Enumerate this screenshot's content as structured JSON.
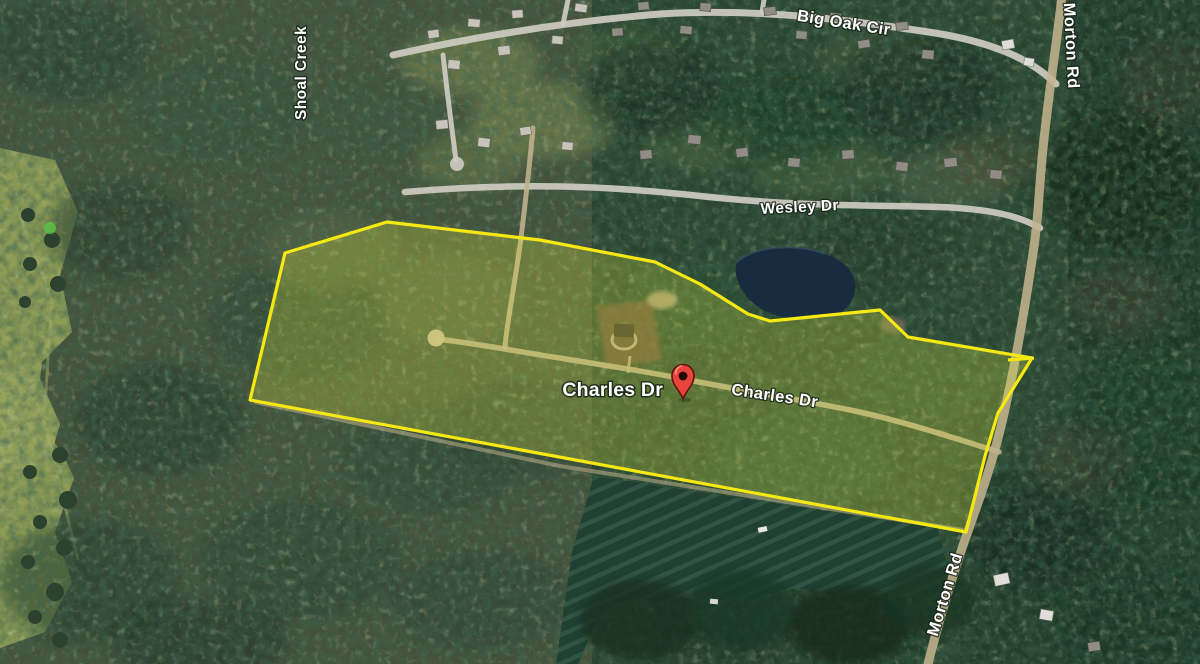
{
  "labels": {
    "big_oak_cir": "Big Oak Cir",
    "shoal_creek": "Shoal Creek",
    "wesley_dr": "Wesley Dr",
    "morton_rd_top": "Morton Rd",
    "morton_rd_bottom": "Morton Rd",
    "charles_dr_place": "Charles Dr",
    "charles_dr_road": "Charles Dr"
  },
  "marker": {
    "label": "Charles Dr",
    "pin_color": "#E8443C",
    "pin_outline": "#5E120B",
    "tip_x": "683",
    "tip_y": "399"
  },
  "parcel": {
    "points": "387,222 540,240 655,262 700,284 748,314 770,321 880,310 908,337 1032,358 998,413 985,456 966,532 250,400 285,253",
    "stroke_color": "#F6E812",
    "fill_color": "#DFE63C",
    "fill_opacity": "0.26",
    "stroke_width": "3.2"
  }
}
